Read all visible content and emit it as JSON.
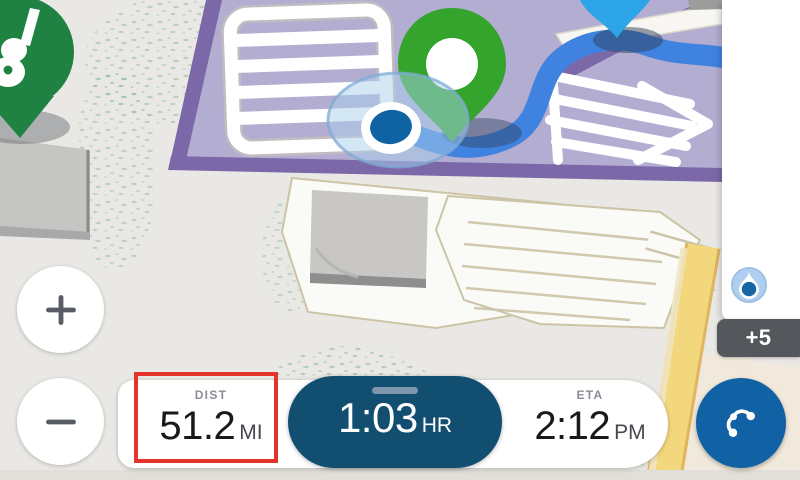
{
  "app": {
    "name": "navigation-map"
  },
  "status_bar": {
    "dist": {
      "label": "DIST",
      "value": "51.2",
      "unit": "MI"
    },
    "time": {
      "value": "1:03",
      "unit": "HR"
    },
    "eta": {
      "label": "ETA",
      "value": "2:12",
      "unit": "PM"
    }
  },
  "notifications": {
    "count": "+5"
  },
  "colors": {
    "pill": "#114E70",
    "action": "#1162A4",
    "route": "#3F82DF",
    "destination_pin": "#35A42C",
    "waypoint_pin": "#2EA4E9",
    "poi_pin": "#1F8243",
    "location_dot": "#0F63A2",
    "highlight": "#E3352B",
    "badge": "#54575C",
    "road_yellow": "#F3D77D",
    "lot_purple": "#B2ADD1",
    "lot_purple_dark": "#7B68A9"
  }
}
